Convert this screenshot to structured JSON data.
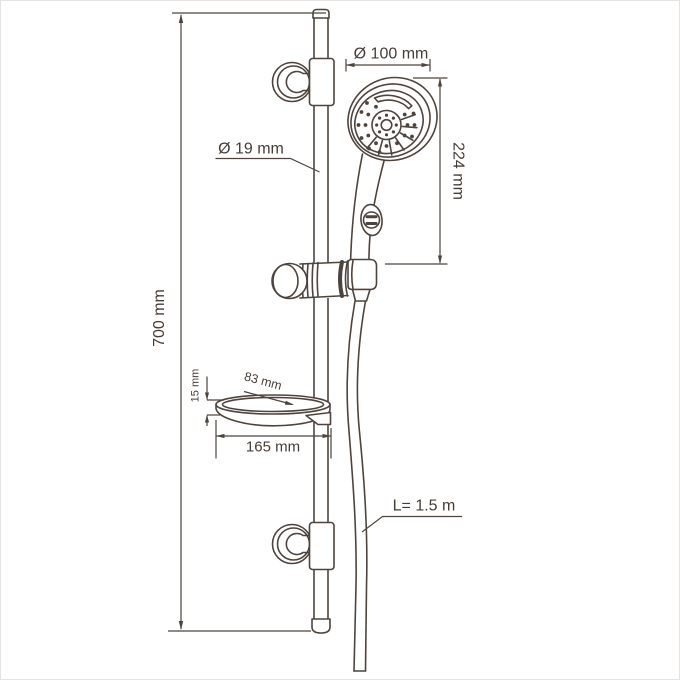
{
  "diagram": {
    "background_color": "#ffffff",
    "line_color": "#4e443d",
    "text_color": "#463c36",
    "dimensions": {
      "bar_height": "700 mm",
      "bar_diameter": "Ø 19 mm",
      "head_diameter": "Ø 100 mm",
      "hand_shower_length": "224 mm",
      "soap_dish_height": "15 mm",
      "soap_dish_depth": "83 mm",
      "soap_dish_width": "165 mm",
      "hose_length": "L= 1.5 m"
    }
  }
}
